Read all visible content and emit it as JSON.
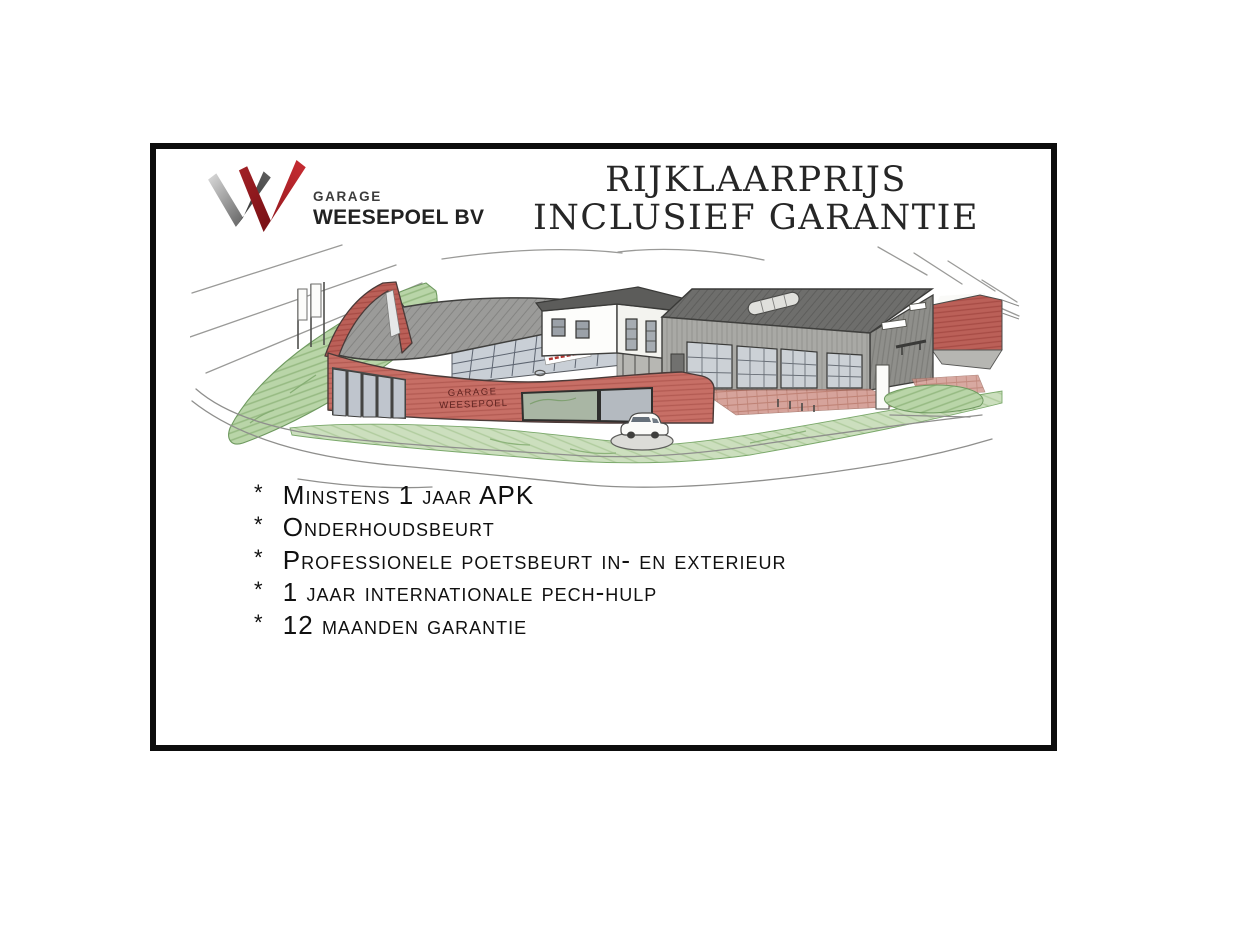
{
  "page": {
    "background": "#ffffff"
  },
  "frame": {
    "border_color": "#0d0d0d"
  },
  "logo": {
    "line1": "GARAGE",
    "line2": "WEESEPOEL BV",
    "mark_colors": {
      "gray_light": "#d8d8d8",
      "gray_dark": "#474747",
      "red_bright": "#b5232a",
      "red_dark": "#8c161b"
    }
  },
  "title": {
    "line1": "RIJKLAARPRIJS",
    "line2": "INCLUSIEF GARANTIE"
  },
  "illustration": {
    "description": "Hand-drawn colored-pencil sketch of the Garage Weesepoel premises: curved red showroom with grey roof and rear fin, glass curtain wall, white tower, grey workshop with glass doors, flag poles, hedges, lawn with display car and sketched roads",
    "sign_line1": "GARAGE",
    "sign_line2": "WEESEPOEL",
    "colors": {
      "wall_red": "#c76f66",
      "roof_grey": "#9c9c9a",
      "glass": "#c9cfd6",
      "green": "#cbdfbd",
      "workshop_grey": "#a8a8a4"
    }
  },
  "features": {
    "bullet": "*",
    "items": [
      "Minstens 1 jaar APK",
      "Onderhoudsbeurt",
      "Professionele poetsbeurt in- en exterieur",
      "1 jaar internationale pech-hulp",
      "12 maanden garantie"
    ]
  }
}
